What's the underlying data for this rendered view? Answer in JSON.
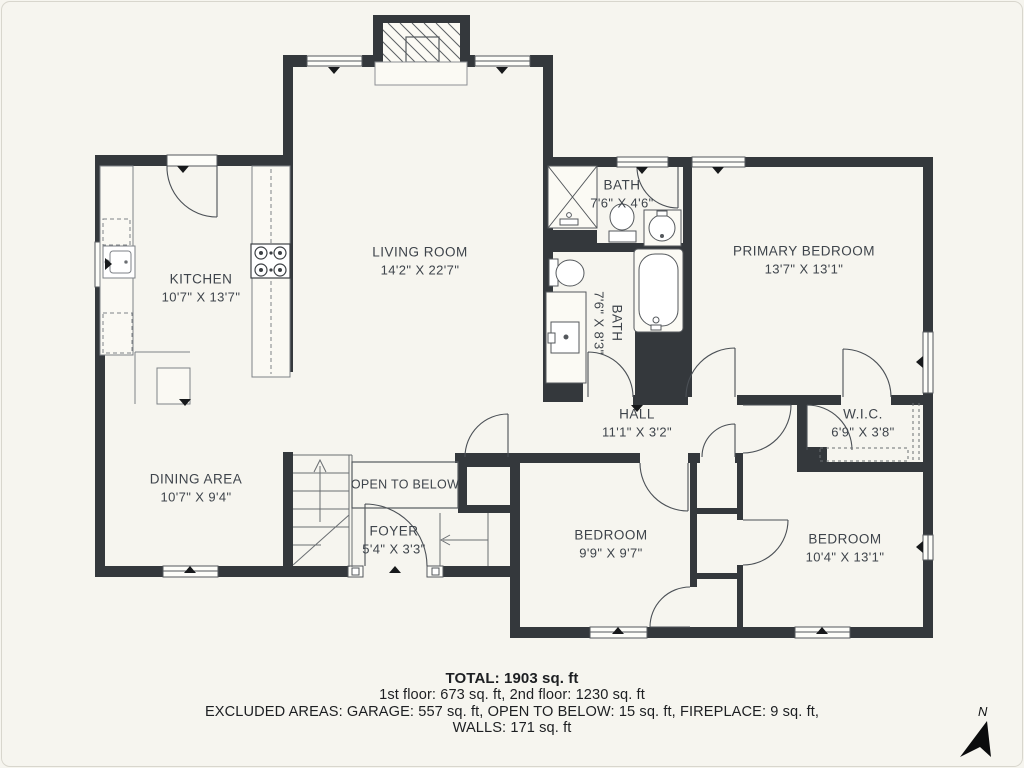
{
  "rooms": {
    "kitchen": {
      "name": "KITCHEN",
      "dims": "10'7\" X 13'7\""
    },
    "living_room": {
      "name": "LIVING ROOM",
      "dims": "14'2\" X 22'7\""
    },
    "dining_area": {
      "name": "DINING AREA",
      "dims": "10'7\" X 9'4\""
    },
    "bath_upper": {
      "name": "BATH",
      "dims": "7'6\" X 4'6\""
    },
    "bath_lower": {
      "name": "BATH",
      "dims": "7'6\" X 8'3\""
    },
    "primary_bedroom": {
      "name": "PRIMARY BEDROOM",
      "dims": "13'7\" X 13'1\""
    },
    "hall": {
      "name": "HALL",
      "dims": "11'1\" X 3'2\""
    },
    "wic": {
      "name": "W.I.C.",
      "dims": "6'9\" X 3'8\""
    },
    "bedroom_left": {
      "name": "BEDROOM",
      "dims": "9'9\" X 9'7\""
    },
    "bedroom_right": {
      "name": "BEDROOM",
      "dims": "10'4\" X 13'1\""
    },
    "open_to_below": {
      "name": "OPEN TO BELOW"
    },
    "foyer": {
      "name": "FOYER",
      "dims": "5'4\" X 3'3\""
    }
  },
  "summary": {
    "total": "TOTAL: 1903 sq. ft",
    "floors": "1st floor: 673 sq. ft, 2nd floor: 1230 sq. ft",
    "excluded": "EXCLUDED AREAS: GARAGE: 557 sq. ft, OPEN TO BELOW: 15 sq. ft, FIREPLACE: 9 sq. ft,",
    "walls": "WALLS: 171 sq. ft"
  },
  "compass": {
    "label": "N"
  },
  "colors": {
    "background": "#f6f5ef",
    "wall": "#34383c",
    "line": "#4b5056"
  }
}
